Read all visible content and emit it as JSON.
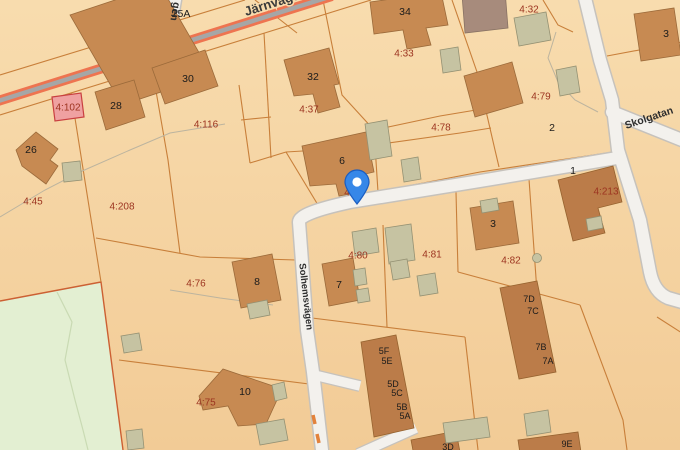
{
  "map": {
    "type": "cadastral-map",
    "streets": {
      "railway": "Järnvägen",
      "partial": "gen",
      "skolgatan": "Skolgatan",
      "solhems": "Solhemsvägen"
    },
    "selected_parcel": "4:102",
    "parcels": [
      "4:102",
      "4:116",
      "4:45",
      "4:208",
      "4:76",
      "4:75",
      "4:37",
      "4:33",
      "4:32",
      "4:79",
      "4:78",
      "4:80",
      "4:81",
      "4:82",
      "4:213",
      "4"
    ],
    "addresses": [
      "25A",
      "30",
      "28",
      "26",
      "32",
      "34",
      "6",
      "2",
      "1",
      "3",
      "3",
      "7",
      "8",
      "10",
      "5F",
      "5E",
      "5D",
      "5C",
      "5B",
      "5A",
      "7D",
      "7C",
      "7B",
      "7A",
      "3D",
      "9E"
    ],
    "pin": {
      "kind": "location-marker"
    },
    "colors": {
      "background_top": "#f8dcae",
      "background_bottom": "#f2cb96",
      "building": "#c78a52",
      "building_dark": "#bb7c49",
      "building_gray": "#c6c3a2",
      "building_brown": "#a78b7c",
      "parcel_line": "#c87f3a",
      "parcel_label": "#9c3420",
      "selected_parcel_fill": "#efa1a1",
      "selected_parcel_stroke": "#c94040",
      "green_area": "#e3efd2",
      "road_fill": "#f3f1ed",
      "railway_orange": "#ee7450",
      "railway_gray": "#a6a6a6",
      "pin_blue": "#3687e8"
    }
  }
}
